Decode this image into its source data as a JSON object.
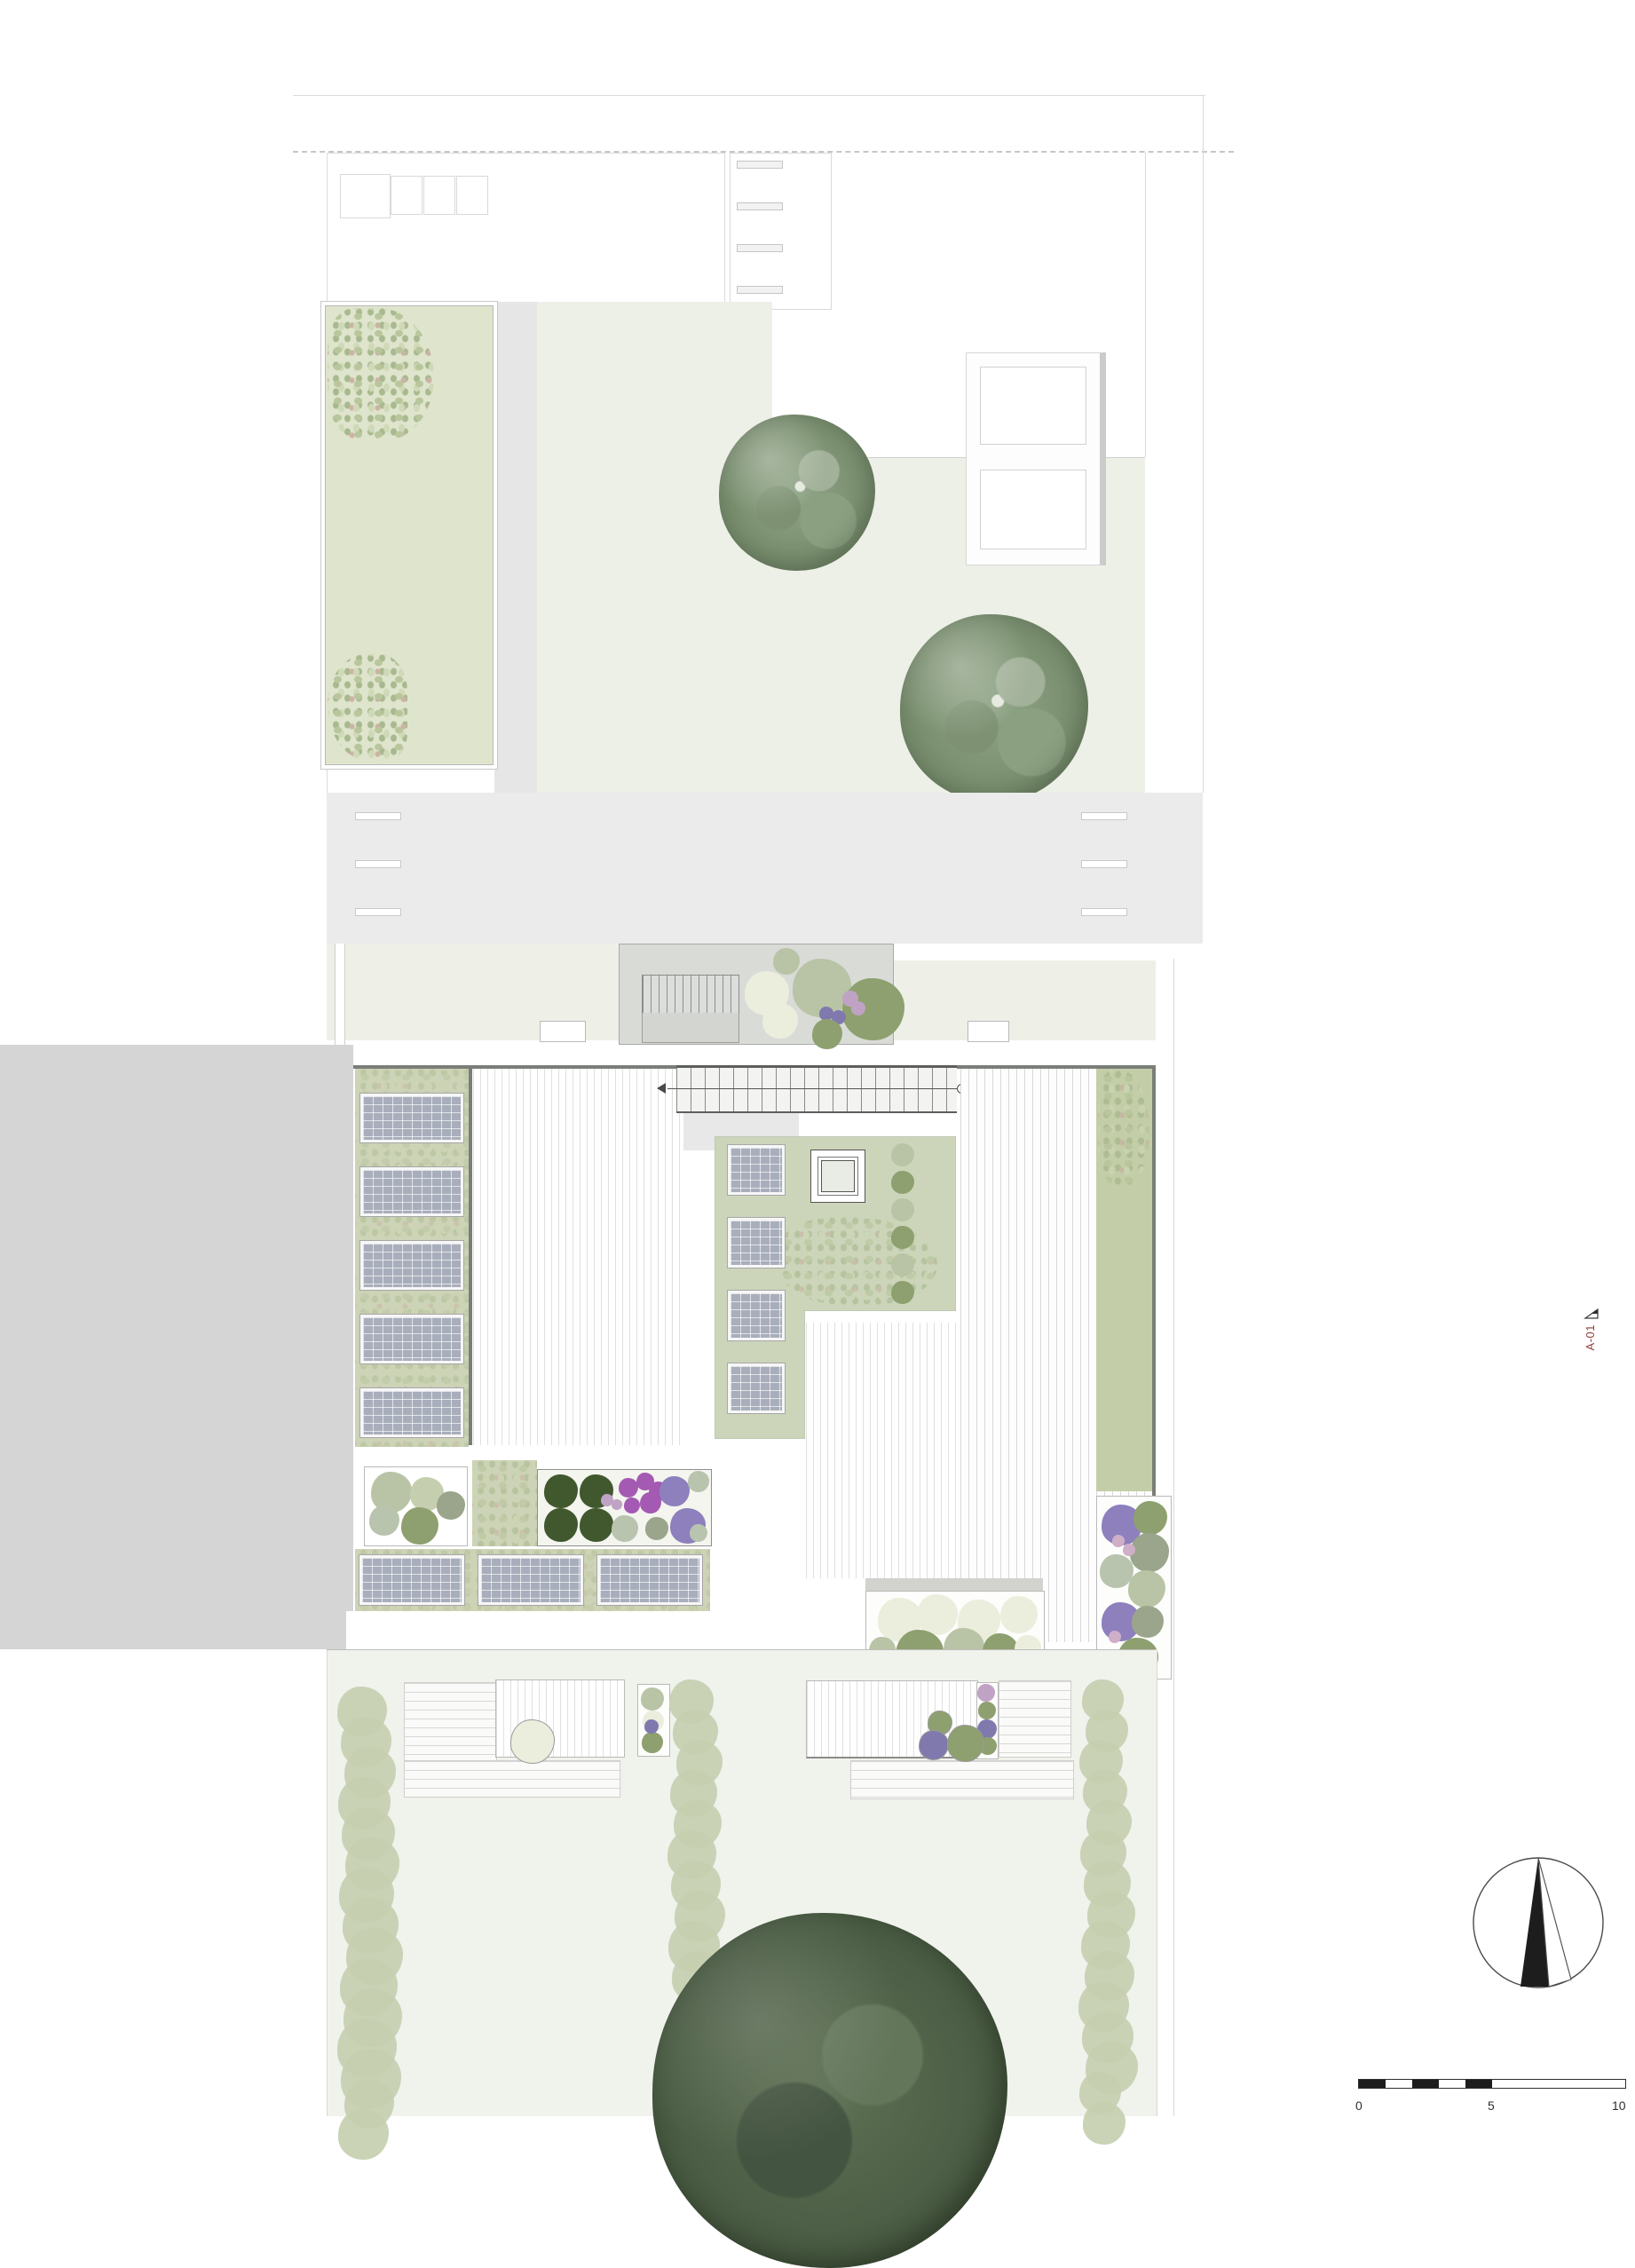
{
  "plan": {
    "scale_bar": {
      "labels": [
        "0",
        "5",
        "10"
      ]
    },
    "section_marker": {
      "label": "A-01"
    },
    "north_arrow": {
      "icon": "north-arrow-icon"
    },
    "roof": {
      "left_solar_rows": 5,
      "bottom_solar_panels": 3,
      "courtyard_solar_squares": 4,
      "sill_marks": 4,
      "lane_mark_rows": 3
    },
    "colors": {
      "lawn": "#edf0e6",
      "garden_plot": "#dfe5cd",
      "road": "#ebebeb",
      "neighbor_gray": "#d5d5d5",
      "sedum_roof": "#cdd3b6",
      "courtyard_green": "#ccd5ba",
      "green_strip": "#c3cda8",
      "solar_panel": "#a9aebc",
      "roof_edge": "#7a7e78",
      "marker_red": "#93403a",
      "sage": "#b9c4a6",
      "green_bush": "#8ea06f",
      "dark_topiary": "#41582f",
      "white_flower": "#ebeedd",
      "lavender": "#8d80bd",
      "allium_purple": "#a45ab2",
      "mauve": "#c0a3c4",
      "grass": "#9aa58c",
      "silver": "#b9c4ae",
      "violet_ball": "#8079ae",
      "pink_ball": "#cfaec8",
      "hedge": "#c5cfb0"
    }
  }
}
